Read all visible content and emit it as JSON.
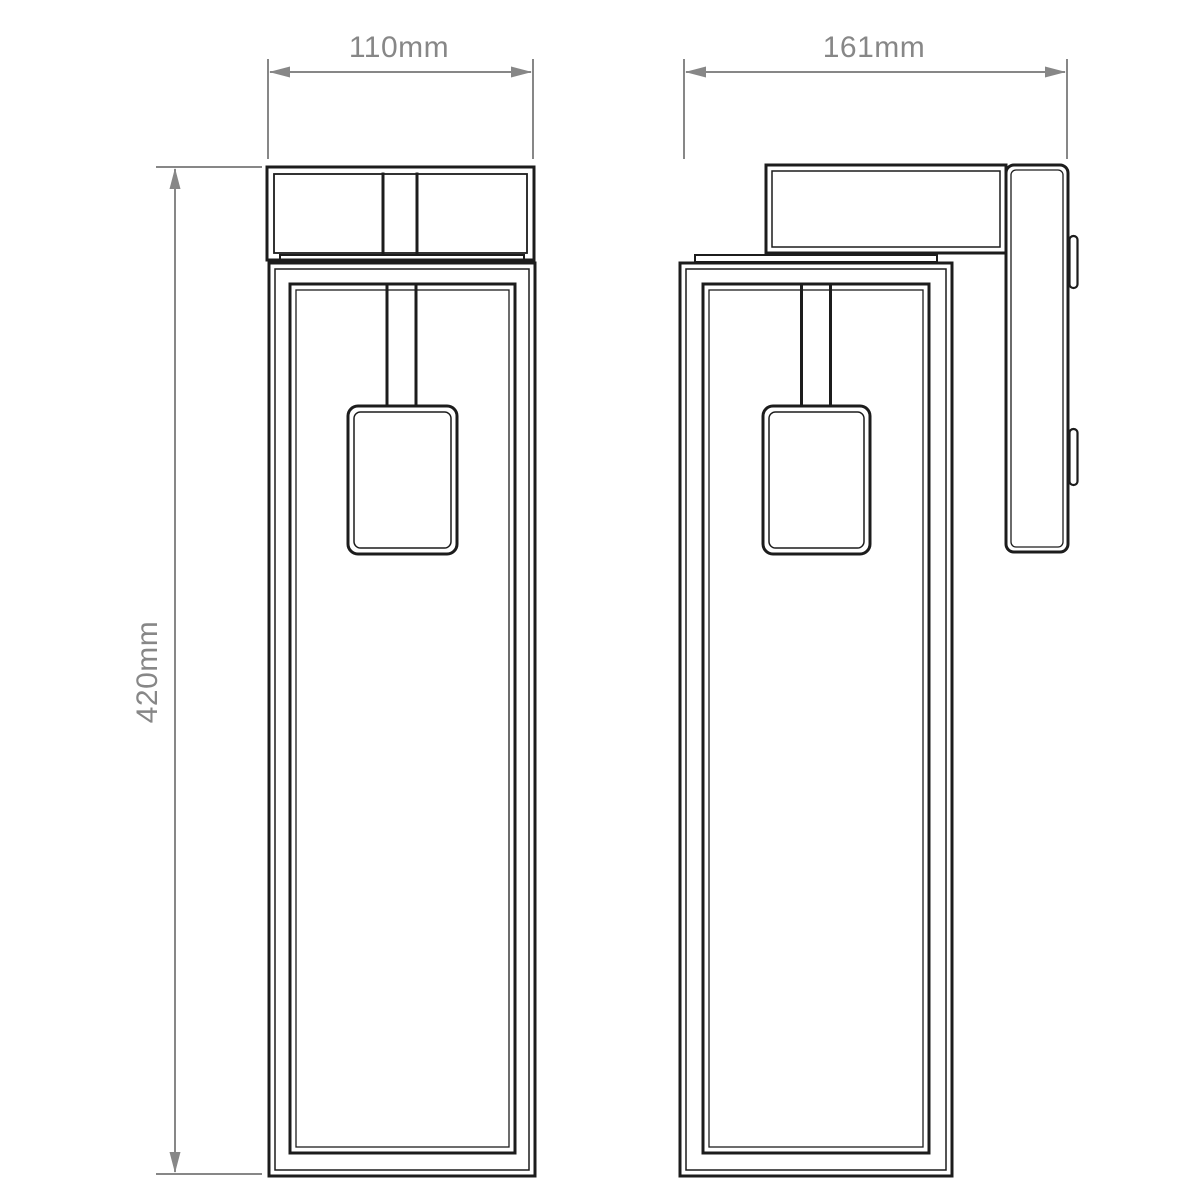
{
  "colors": {
    "background": "#ffffff",
    "drawing_lines": "#1c1c1c",
    "dimension_lines": "#878787"
  },
  "dimensions": {
    "front_width": {
      "label": "110mm"
    },
    "side_depth": {
      "label": "161mm"
    },
    "height": {
      "label": "420mm"
    }
  }
}
